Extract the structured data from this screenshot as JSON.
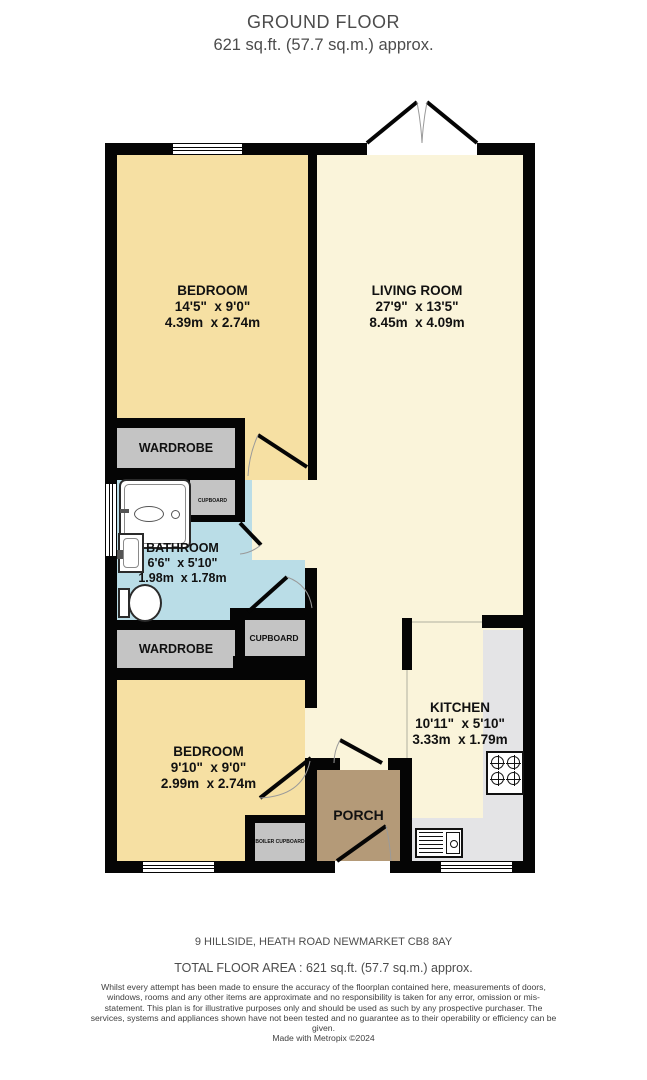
{
  "header": {
    "title": "GROUND FLOOR",
    "subtitle": "621 sq.ft. (57.7 sq.m.) approx."
  },
  "rooms": {
    "bedroom1": {
      "name": "BEDROOM",
      "size_imperial": "14'5\"  x 9'0\"",
      "size_metric": "4.39m  x 2.74m"
    },
    "living_room": {
      "name": "LIVING ROOM",
      "size_imperial": "27'9\"  x 13'5\"",
      "size_metric": "8.45m  x 4.09m"
    },
    "bathroom": {
      "name": "BATHROOM",
      "size_imperial": "6'6\"  x 5'10\"",
      "size_metric": "1.98m  x 1.78m"
    },
    "bedroom2": {
      "name": "BEDROOM",
      "size_imperial": "9'10\"  x 9'0\"",
      "size_metric": "2.99m  x 2.74m"
    },
    "kitchen": {
      "name": "KITCHEN",
      "size_imperial": "10'11\"  x 5'10\"",
      "size_metric": "3.33m  x 1.79m"
    },
    "porch": {
      "name": "PORCH"
    },
    "wardrobe1": {
      "name": "WARDROBE"
    },
    "wardrobe2": {
      "name": "WARDROBE"
    },
    "cupboard1": {
      "name": "CUPBOARD"
    },
    "cupboard2": {
      "name": "CUPBOARD"
    },
    "boiler_cupboard": {
      "name": "BOILER CUPBOARD"
    }
  },
  "footer": {
    "address": "9 HILLSIDE, HEATH ROAD NEWMARKET CB8 8AY",
    "total_area": "TOTAL FLOOR AREA : 621 sq.ft. (57.7 sq.m.) approx.",
    "disclaimer": "Whilst every attempt has been made to ensure the accuracy of the floorplan contained here, measurements of doors, windows, rooms and any other items are approximate and no responsibility is taken for any error, omission or mis-statement. This plan is for illustrative purposes only and should be used as such by any prospective purchaser. The services, systems and appliances shown have not been tested and no guarantee as to their operability or efficiency can be given.",
    "credit": "Made with Metropix ©2024"
  },
  "colors": {
    "wall": "#050505",
    "living_fill": "#faf4da",
    "bedroom_fill": "#f6e0a3",
    "bathroom_fill": "#badde7",
    "storage_fill": "#c4c4c4",
    "porch_fill": "#b49a78",
    "counter_fill": "#e4e4e6"
  }
}
